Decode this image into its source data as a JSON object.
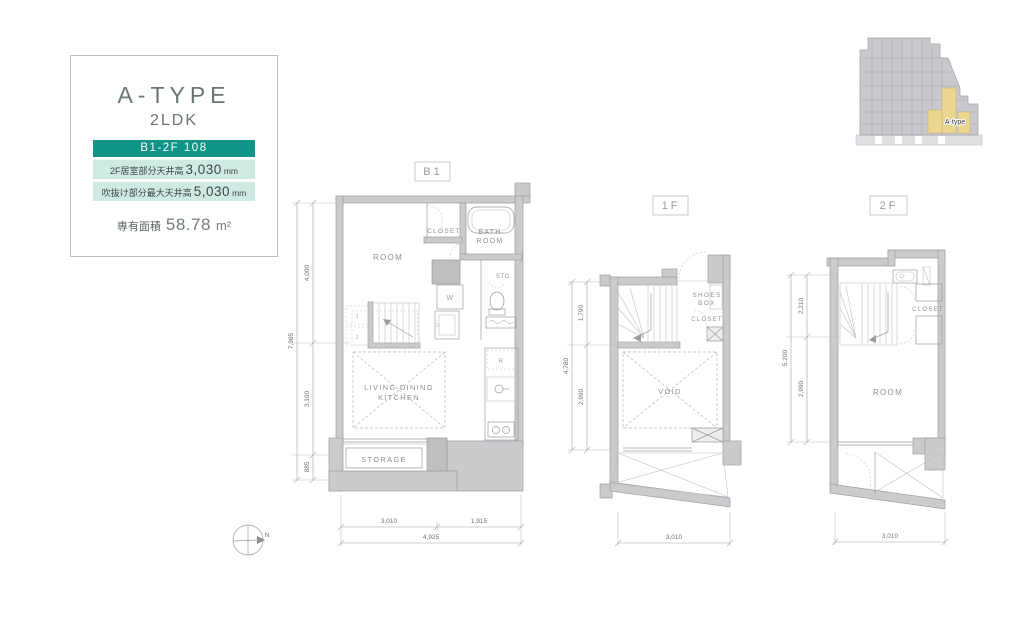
{
  "title_card": {
    "type_name": "A-TYPE",
    "layout": "2LDK",
    "badge": "B1-2F 108",
    "specs": [
      {
        "label": "2F居室部分天井高",
        "value": "3,030",
        "unit": "mm"
      },
      {
        "label": "吹抜け部分最大天井高",
        "value": "5,030",
        "unit": "mm"
      }
    ],
    "area_label": "専有面積",
    "area_value": "58.78",
    "area_unit": "m²"
  },
  "overview": {
    "highlight_label": "A-type"
  },
  "compass_label": "N",
  "colors": {
    "accent_teal": "#0F9487",
    "accent_teal_light": "#CFE9E3",
    "wall_gray": "#CBCBCD",
    "highlight_yellow": "#EBD78F"
  },
  "floors": {
    "b1": {
      "label": "B1",
      "rooms": {
        "room": "ROOM",
        "closet": "CLOSET",
        "bath_lines": [
          "BATH",
          "ROOM"
        ],
        "sto": "STO.",
        "washer": "W",
        "j_upper": "J",
        "j_lower": "J",
        "fridge": "R",
        "ldk_lines": [
          "LIVING DINING",
          "KITCHEN"
        ],
        "storage": "STORAGE"
      },
      "dims": {
        "v_total": "7,985",
        "v_top": "4,000",
        "v_mid": "3,100",
        "v_bottom": "885",
        "h_left": "3,010",
        "h_right": "1,915",
        "h_total": "4,925"
      }
    },
    "f1": {
      "label": "1F",
      "rooms": {
        "shoes_lines": [
          "SHOES",
          "BOX"
        ],
        "closet": "CLOSET",
        "void": "VOID"
      },
      "dims": {
        "v_total": "4,780",
        "v_top": "1,790",
        "v_bottom": "2,990",
        "h_width": "3,010"
      }
    },
    "f2": {
      "label": "2F",
      "rooms": {
        "closet": "CLOSET",
        "room": "ROOM"
      },
      "dims": {
        "v_total": "5,200",
        "v_top": "2,210",
        "v_bottom": "2,990",
        "h_width": "3,010"
      }
    }
  }
}
